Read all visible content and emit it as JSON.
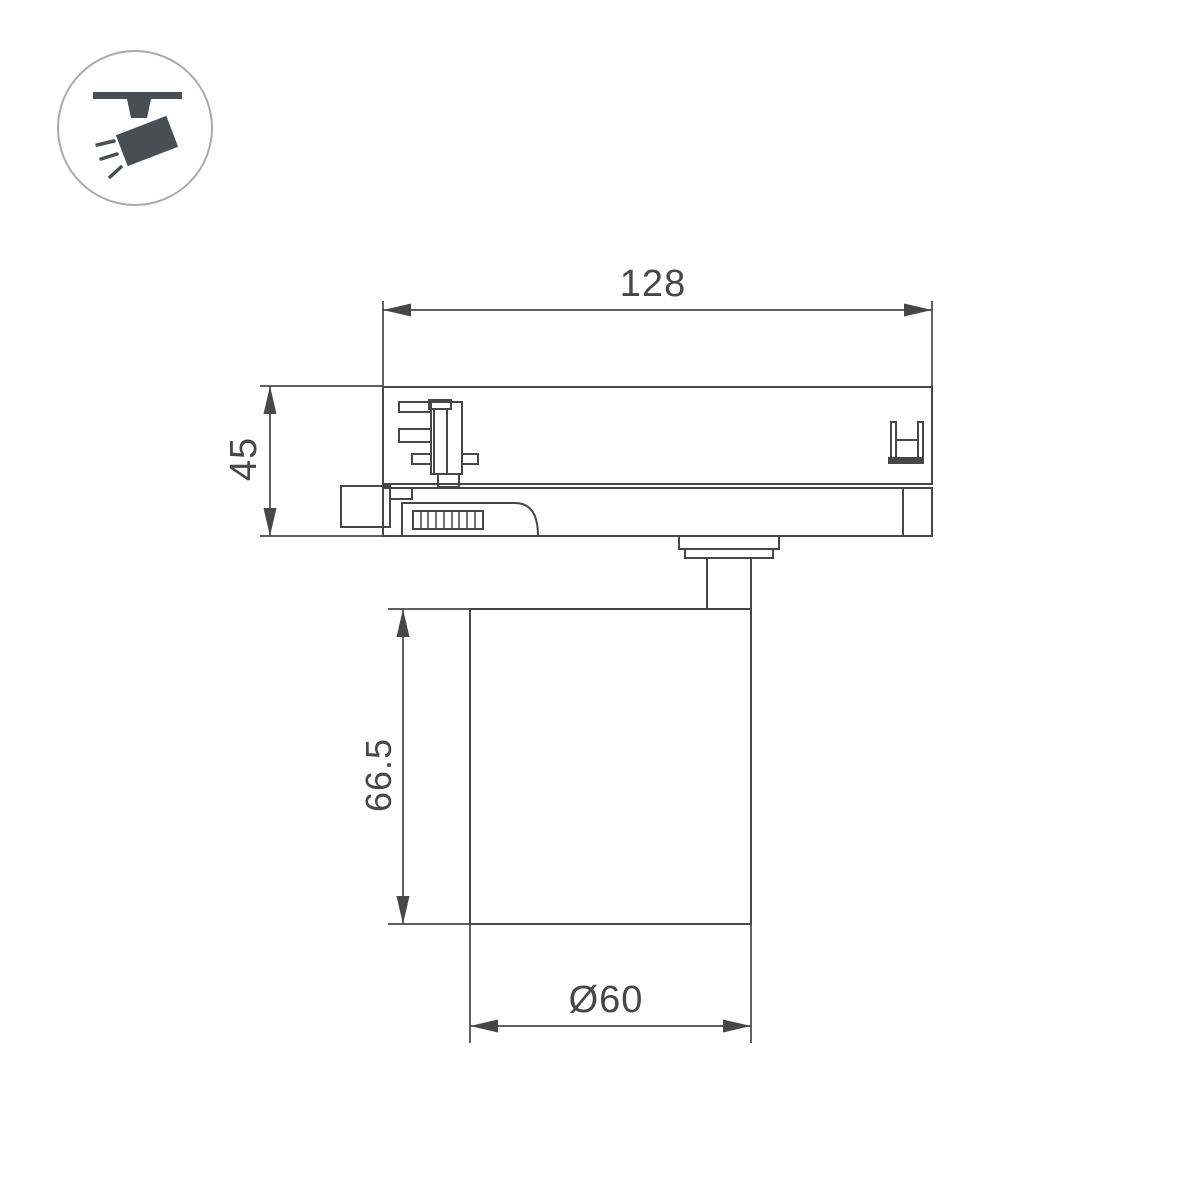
{
  "icon": {
    "name": "track-spotlight-icon"
  },
  "dimension_labels": {
    "overall_width": "128",
    "adapter_height": "45",
    "body_height": "66.5",
    "body_diameter": "Ø60"
  },
  "colors": {
    "line": "#454749",
    "text": "#454749",
    "icon_fill": "#474f54",
    "icon_circle_stroke": "#a6abae",
    "background": "#ffffff"
  }
}
